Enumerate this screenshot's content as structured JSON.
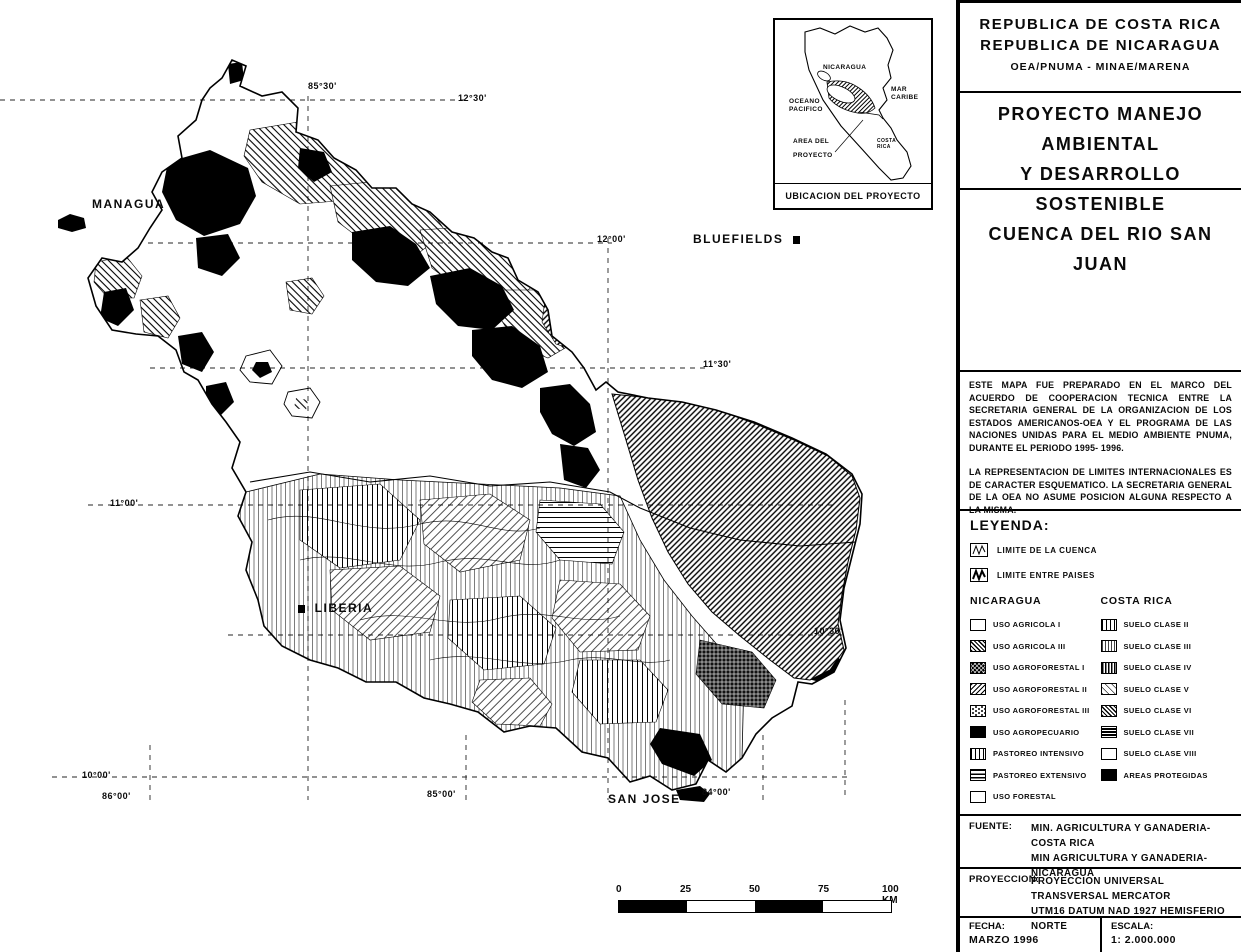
{
  "panel": {
    "header": {
      "line1": "REPUBLICA DE COSTA RICA",
      "line2": "REPUBLICA DE NICARAGUA",
      "line3": "OEA/PNUMA - MINAE/MARENA"
    },
    "title": {
      "line1": "PROYECTO MANEJO AMBIENTAL",
      "line2": "Y DESARROLLO SOSTENIBLE",
      "line3": "CUENCA DEL RIO SAN JUAN"
    },
    "notes": {
      "paragraph1": "ESTE MAPA FUE PREPARADO EN EL MARCO DEL ACUERDO DE COOPERACION TECNICA ENTRE LA SECRETARIA GENERAL DE LA ORGANIZACION DE LOS ESTADOS AMERICANOS-OEA Y EL PROGRAMA DE LAS NACIONES UNIDAS PARA EL MEDIO AMBIENTE PNUMA, DURANTE EL PERIODO 1995- 1996.",
      "paragraph2": "LA REPRESENTACION DE LIMITES INTERNACIONALES ES DE CARACTER ESQUEMATICO. LA SECRETARIA GENERAL DE LA OEA NO ASUME POSICION ALGUNA RESPECTO A LA MISMA."
    },
    "legend": {
      "title": "LEYENDA:",
      "boundaries": [
        {
          "label": "LIMITE DE LA CUENCA"
        },
        {
          "label": "LIMITE ENTRE PAISES"
        }
      ],
      "nicaragua": {
        "title": "NICARAGUA",
        "items": [
          {
            "label": "USO AGRICOLA I",
            "pattern": "white"
          },
          {
            "label": "USO AGRICOLA III",
            "pattern": "diag-dense"
          },
          {
            "label": "USO AGROFORESTAL I",
            "pattern": "dark-cross"
          },
          {
            "label": "USO AGROFORESTAL II",
            "pattern": "diag-fs"
          },
          {
            "label": "USO AGROFORESTAL III",
            "pattern": "scales"
          },
          {
            "label": "USO AGROPECUARIO",
            "pattern": "black"
          },
          {
            "label": "PASTOREO INTENSIVO",
            "pattern": "vert"
          },
          {
            "label": "PASTOREO EXTENSIVO",
            "pattern": "horiz"
          },
          {
            "label": "USO FORESTAL",
            "pattern": "white"
          }
        ]
      },
      "costa_rica": {
        "title": "COSTA RICA",
        "items": [
          {
            "label": "SUELO CLASE II",
            "pattern": "vert"
          },
          {
            "label": "SUELO CLASE III",
            "pattern": "vert-fine"
          },
          {
            "label": "SUELO CLASE IV",
            "pattern": "vert-dense"
          },
          {
            "label": "SUELO CLASE V",
            "pattern": "diag-light"
          },
          {
            "label": "SUELO CLASE VI",
            "pattern": "diag-dense"
          },
          {
            "label": "SUELO CLASE VII",
            "pattern": "dark-horiz"
          },
          {
            "label": "SUELO CLASE VIII",
            "pattern": "white"
          },
          {
            "label": "AREAS PROTEGIDAS",
            "pattern": "black"
          }
        ]
      }
    },
    "fuente": {
      "label": "FUENTE:",
      "line1": "MIN. AGRICULTURA Y GANADERIA-COSTA RICA",
      "line2": "MIN AGRICULTURA Y GANADERIA-NICARAGUA"
    },
    "proyeccion": {
      "label": "PROYECCION:",
      "line1": "PROYECCION UNIVERSAL TRANSVERSAL MERCATOR",
      "line2": "UTM16 DATUM NAD 1927 HEMISFERIO NORTE"
    },
    "fecha": {
      "label": "FECHA:",
      "value": "MARZO 1996"
    },
    "escala": {
      "label": "ESCALA:",
      "value": "1: 2.000.000"
    }
  },
  "inset": {
    "nicaragua": "NICARAGUA",
    "mar_caribe_1": "MAR",
    "mar_caribe_2": "CARIBE",
    "oceano_1": "OCEANO",
    "oceano_2": "PACIFICO",
    "area_1": "AREA DEL",
    "area_2": "PROYECTO",
    "costa_rica_1": "COSTA",
    "costa_rica_2": "RICA",
    "caption": "UBICACION DEL PROYECTO"
  },
  "map": {
    "cities": {
      "managua": "MANAGUA",
      "bluefields": "BLUEFIELDS",
      "liberia": "LIBERIA",
      "san_jose": "SAN JOSE"
    },
    "grid_labels": {
      "lon_85_30": "85°30'",
      "lat_12_30": "12°30'",
      "lat_12_00": "12°00'",
      "lat_11_30": "11°30'",
      "lat_11_00": "11°00'",
      "lat_10_30": "10°30'",
      "lat_10_00": "10°00'",
      "lon_86_00": "86°00'",
      "lon_85_00": "85°00'",
      "lon_84_00": "84°00'"
    },
    "scalebar": {
      "t0": "0",
      "t25": "25",
      "t50": "50",
      "t75": "75",
      "t100": "100 KM"
    }
  }
}
